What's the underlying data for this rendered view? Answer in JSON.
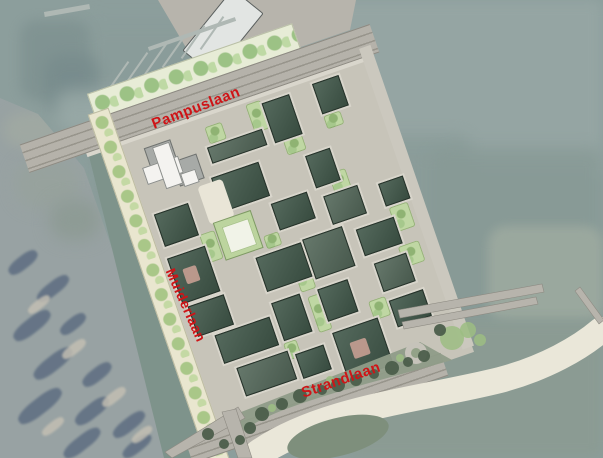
{
  "map": {
    "description": "Urban development site plan overlaid on aerial photo with surrounding water",
    "labels": {
      "pampuslaan": {
        "text": "Pampuslaan",
        "x": 196,
        "y": 108,
        "rotation": -21,
        "size": 15
      },
      "muiderlaan": {
        "text": "Muiderlaan",
        "x": 186,
        "y": 305,
        "rotation": 66,
        "size": 14
      },
      "strandlaan": {
        "text": "Strandlaan",
        "x": 341,
        "y": 380,
        "rotation": -19,
        "size": 15
      }
    },
    "colors": {
      "label_red": "#CE1417",
      "water_base": "#8C9E9C",
      "canal": "#7E938B",
      "road": "#B5B2AA",
      "street": "#C7C4B9",
      "block_green": "#41584A",
      "park_green": "#BFD7A3",
      "sand": "#EAE7D9",
      "grass": "#8F9C88",
      "landmark_white": "#F4F3F0",
      "quay_gray": "#B7B4AC"
    },
    "geometry": {
      "water_patches": [
        {
          "x": 285,
          "y": 0,
          "w": 318,
          "h": 178,
          "c": "#95A5A3",
          "b": 6,
          "o": 1,
          "r": 8
        },
        {
          "x": 295,
          "y": 135,
          "w": 175,
          "h": 125,
          "c": "#8A9C99",
          "b": 8,
          "o": 0.9,
          "r": 10
        },
        {
          "x": 430,
          "y": 148,
          "w": 173,
          "h": 180,
          "c": "#889A96",
          "b": 8,
          "o": 0.9,
          "r": 10
        },
        {
          "x": 488,
          "y": 226,
          "w": 115,
          "h": 96,
          "c": "#9CA99F",
          "b": 5,
          "o": 0.95,
          "r": 18
        },
        {
          "x": 348,
          "y": 320,
          "w": 255,
          "h": 138,
          "c": "#8B9B93",
          "b": 6,
          "o": 1,
          "r": 8
        },
        {
          "x": 80,
          "y": 20,
          "w": 220,
          "h": 150,
          "c": "#8A9C9A",
          "b": 10,
          "o": 0.6,
          "r": 12
        },
        {
          "x": 20,
          "y": 20,
          "w": 70,
          "h": 80,
          "c": "#7E9190",
          "b": 6,
          "o": 0.8,
          "r": 16
        },
        {
          "x": 45,
          "y": 55,
          "w": 55,
          "h": 60,
          "c": "#768A8B",
          "b": 7,
          "o": 0.7,
          "r": 16
        },
        {
          "x": 55,
          "y": 90,
          "w": 90,
          "h": 40,
          "c": "#9FAFAC",
          "b": 8,
          "o": 0.7,
          "r": 16
        },
        {
          "x": 100,
          "y": 140,
          "w": 40,
          "h": 70,
          "c": "#80938F",
          "b": 7,
          "o": 0.7,
          "r": 14
        }
      ],
      "canal": {
        "points": "82,128 118,132 204,458 164,458",
        "color": "#7E938B"
      },
      "photo": {
        "clip": "0,98 38,114 84,168 116,260 150,380 166,458 0,458",
        "city_clip": "0,238 58,252 96,310 140,400 158,458 0,458",
        "upper_blobs": [
          {
            "x": 4,
            "y": 112,
            "w": 54,
            "h": 36,
            "c": "#9FA8A2",
            "b": 6
          },
          {
            "x": 16,
            "y": 160,
            "w": 64,
            "h": 48,
            "c": "#97A29D",
            "b": 8
          },
          {
            "x": 50,
            "y": 200,
            "w": 50,
            "h": 40,
            "c": "#8E9B95",
            "b": 8
          }
        ],
        "dark_blobs": [
          [
            6,
            256,
            34,
            13
          ],
          [
            34,
            282,
            38,
            13
          ],
          [
            10,
            318,
            44,
            15
          ],
          [
            58,
            318,
            30,
            12
          ],
          [
            30,
            356,
            46,
            15
          ],
          [
            80,
            368,
            34,
            13
          ],
          [
            14,
            398,
            52,
            16
          ],
          [
            72,
            404,
            40,
            14
          ],
          [
            110,
            418,
            38,
            13
          ],
          [
            60,
            436,
            44,
            14
          ],
          [
            120,
            440,
            34,
            12
          ]
        ],
        "light_blobs": [
          [
            26,
            300,
            26,
            9
          ],
          [
            60,
            344,
            28,
            10
          ],
          [
            100,
            392,
            28,
            10
          ],
          [
            40,
            422,
            26,
            9
          ],
          [
            130,
            430,
            24,
            9
          ]
        ],
        "blob_angle": -38,
        "dark_color": "#5A6A7F",
        "light_color": "#C6C1B4"
      },
      "site": {
        "x": 126,
        "y": 146,
        "rot": -19,
        "w": 256,
        "h": 300
      },
      "strips": {
        "tree_top": {
          "x": -20,
          "y": -62,
          "w": 215,
          "h": 26
        },
        "road_top": {
          "x": -100,
          "y": -36,
          "w": 370,
          "h": 28
        },
        "sidewalk_top": {
          "x": -40,
          "y": -6,
          "w": 300,
          "h": 4
        },
        "tree_left": {
          "x": -26,
          "y": -42,
          "w": 20,
          "h": 372
        },
        "road_bottom": {
          "x": -40,
          "y": 298,
          "w": 270,
          "h": 22
        },
        "shore_walk": {
          "x": 252,
          "y": -16,
          "w": 12,
          "h": 318
        },
        "street_base": {
          "x": -8,
          "y": -8,
          "w": 270,
          "h": 316
        }
      },
      "blocks": [
        [
          76,
          28,
          56,
          15,
          2
        ],
        [
          142,
          4,
          27,
          40,
          1
        ],
        [
          196,
          2,
          26,
          30,
          1
        ],
        [
          4,
          74,
          34,
          32,
          1
        ],
        [
          70,
          58,
          48,
          34,
          1
        ],
        [
          166,
          68,
          24,
          32,
          1
        ],
        [
          2,
          120,
          38,
          46,
          1,
          1
        ],
        [
          118,
          102,
          36,
          26,
          1
        ],
        [
          170,
          112,
          34,
          28,
          2
        ],
        [
          6,
          172,
          36,
          30,
          1
        ],
        [
          86,
          148,
          46,
          34,
          1
        ],
        [
          136,
          146,
          40,
          40,
          2
        ],
        [
          190,
          154,
          38,
          26,
          1
        ],
        [
          22,
          208,
          56,
          28,
          1
        ],
        [
          86,
          196,
          28,
          38,
          1
        ],
        [
          134,
          198,
          30,
          32,
          1
        ],
        [
          196,
          192,
          32,
          28,
          2
        ],
        [
          32,
          246,
          52,
          28,
          2
        ],
        [
          134,
          244,
          46,
          48,
          1,
          1
        ],
        [
          198,
          232,
          34,
          26,
          1
        ],
        [
          226,
          118,
          24,
          22,
          1
        ],
        [
          92,
          252,
          28,
          24,
          1
        ]
      ],
      "parks": [
        [
          80,
          8,
          18,
          18
        ],
        [
          126,
          0,
          16,
          30
        ],
        [
          150,
          46,
          20,
          16
        ],
        [
          196,
          36,
          18,
          14
        ],
        [
          40,
          108,
          16,
          30
        ],
        [
          100,
          130,
          16,
          14
        ],
        [
          118,
          158,
          16,
          38
        ],
        [
          122,
          202,
          14,
          38
        ],
        [
          182,
          92,
          18,
          22
        ],
        [
          228,
          144,
          20,
          26
        ],
        [
          178,
          226,
          18,
          20
        ],
        [
          84,
          238,
          14,
          18
        ],
        [
          224,
          184,
          22,
          22
        ],
        [
          60,
          210,
          18,
          14
        ]
      ],
      "landmark": {
        "grays": [
          [
            16,
            8,
            26,
            20
          ],
          [
            38,
            30,
            24,
            24
          ]
        ],
        "whites": [
          [
            8,
            26,
            36,
            16
          ],
          [
            24,
            10,
            16,
            42
          ],
          [
            42,
            44,
            14,
            12
          ]
        ]
      },
      "courtyard": {
        "x": 58,
        "y": 102,
        "w": 38,
        "h": 38,
        "ring": "#BCD49E",
        "inner": "#F1F3E8"
      },
      "plaza": {
        "x": 54,
        "y": 62,
        "w": 26,
        "h": 40,
        "c": "#E9E5D7"
      },
      "quay": {
        "outer": {
          "x": 150,
          "y": 0,
          "w": 210,
          "h": 85
        },
        "clip": "8,0 206,0 200,30 55,80",
        "color": "#B7B4AC"
      },
      "quay_building": {
        "x": 203,
        "y": -8,
        "w": 38,
        "h": 78,
        "rot": 39,
        "c": "#E2E5E3"
      },
      "marina": {
        "teeth": {
          "x": 116,
          "y": 58,
          "dx": 19,
          "dy": -9,
          "count": 6,
          "len": 40,
          "w": 2,
          "rot": 35
        },
        "walkway": {
          "x": 104,
          "y": 96,
          "w": 122,
          "h": 3,
          "rot": -26
        },
        "color": "#AFB8B4"
      },
      "breakwaters": [
        {
          "x": 146,
          "y": 32,
          "w": 92,
          "h": 4,
          "rot": -19
        },
        {
          "x": 44,
          "y": 8,
          "w": 46,
          "h": 5,
          "rot": -10
        }
      ],
      "svg": {
        "grass_upper": "M 236 414 L 420 342 L 452 360 C 400 375 340 390 300 404 C 270 414 252 424 242 432 Z",
        "sand_main": "M 256 454 C 320 408 420 400 500 380 C 545 368 580 348 601 330",
        "sand_inner": "M 262 458 C 300 434 330 428 368 424",
        "oval": {
          "cx": 338,
          "cy": 437,
          "rx": 52,
          "ry": 19,
          "rot": -14,
          "c": "#7E8F7C"
        },
        "bridges": [
          "M 398 310 L 542 284 L 544 292 L 400 318 Z",
          "M 402 322 L 536 297 L 538 304 L 404 329 Z",
          "M 575 291 L 599 324 L 604 320 L 580 287 Z",
          "M 165 452 L 238 407 L 245 418 L 172 458 Z",
          "M 222 412 L 236 409 L 252 458 L 238 458 Z"
        ],
        "bridge_color": "#B7B4AC",
        "roundabout": {
          "cx": 416,
          "cy": 353,
          "r": 11,
          "inner": 5
        },
        "trees_dark": [
          [
            250,
            428,
            6
          ],
          [
            262,
            414,
            7
          ],
          [
            282,
            404,
            6
          ],
          [
            300,
            396,
            7
          ],
          [
            322,
            390,
            5
          ],
          [
            338,
            385,
            7
          ],
          [
            356,
            380,
            6
          ],
          [
            374,
            374,
            5
          ],
          [
            392,
            368,
            7
          ],
          [
            408,
            362,
            5
          ],
          [
            424,
            356,
            6
          ],
          [
            208,
            434,
            6
          ],
          [
            224,
            444,
            5
          ],
          [
            240,
            440,
            5
          ],
          [
            440,
            330,
            6
          ]
        ],
        "trees_light": [
          [
            272,
            408,
            4
          ],
          [
            330,
            380,
            4
          ],
          [
            400,
            358,
            4
          ],
          [
            452,
            338,
            12
          ],
          [
            468,
            330,
            8
          ],
          [
            480,
            340,
            6
          ]
        ],
        "tree_dark_color": "#4C5E4B",
        "tree_light_color": "#9CBD83"
      }
    }
  }
}
